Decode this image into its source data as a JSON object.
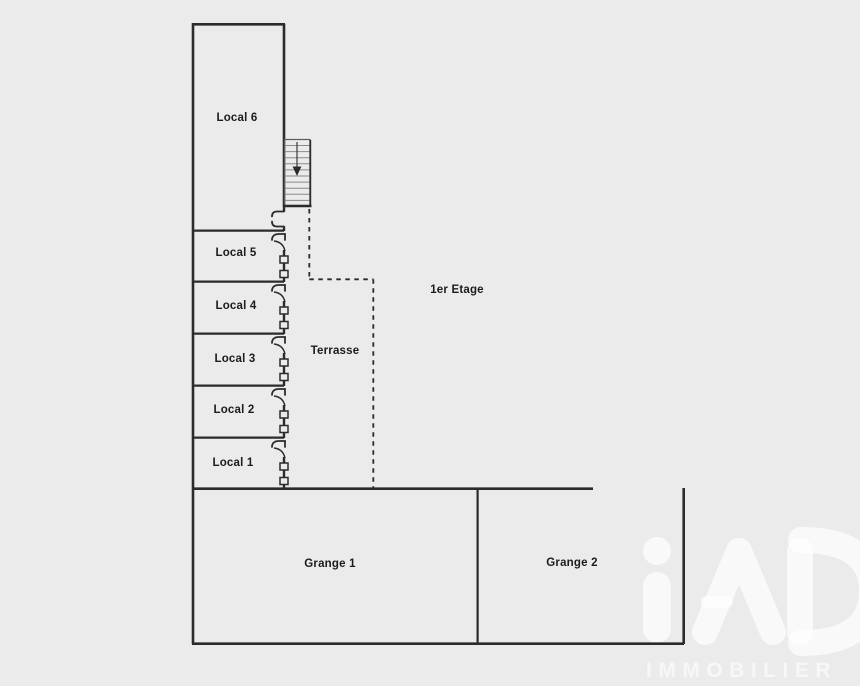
{
  "colors": {
    "bg": "#ebebeb",
    "wall": "#2b2b2b",
    "tread": "#8a8a8a",
    "text": "#1c1c1c",
    "wm": "#ffffff"
  },
  "plan": {
    "floor_label": "1er Etage",
    "locals": [
      "Local 6",
      "Local 5",
      "Local 4",
      "Local 3",
      "Local 2",
      "Local 1"
    ],
    "terrace_label": "Terrasse",
    "granges": [
      "Grange 1",
      "Grange 2"
    ]
  },
  "watermark": {
    "brand": "iad",
    "subtitle": "IMMOBILIER"
  }
}
